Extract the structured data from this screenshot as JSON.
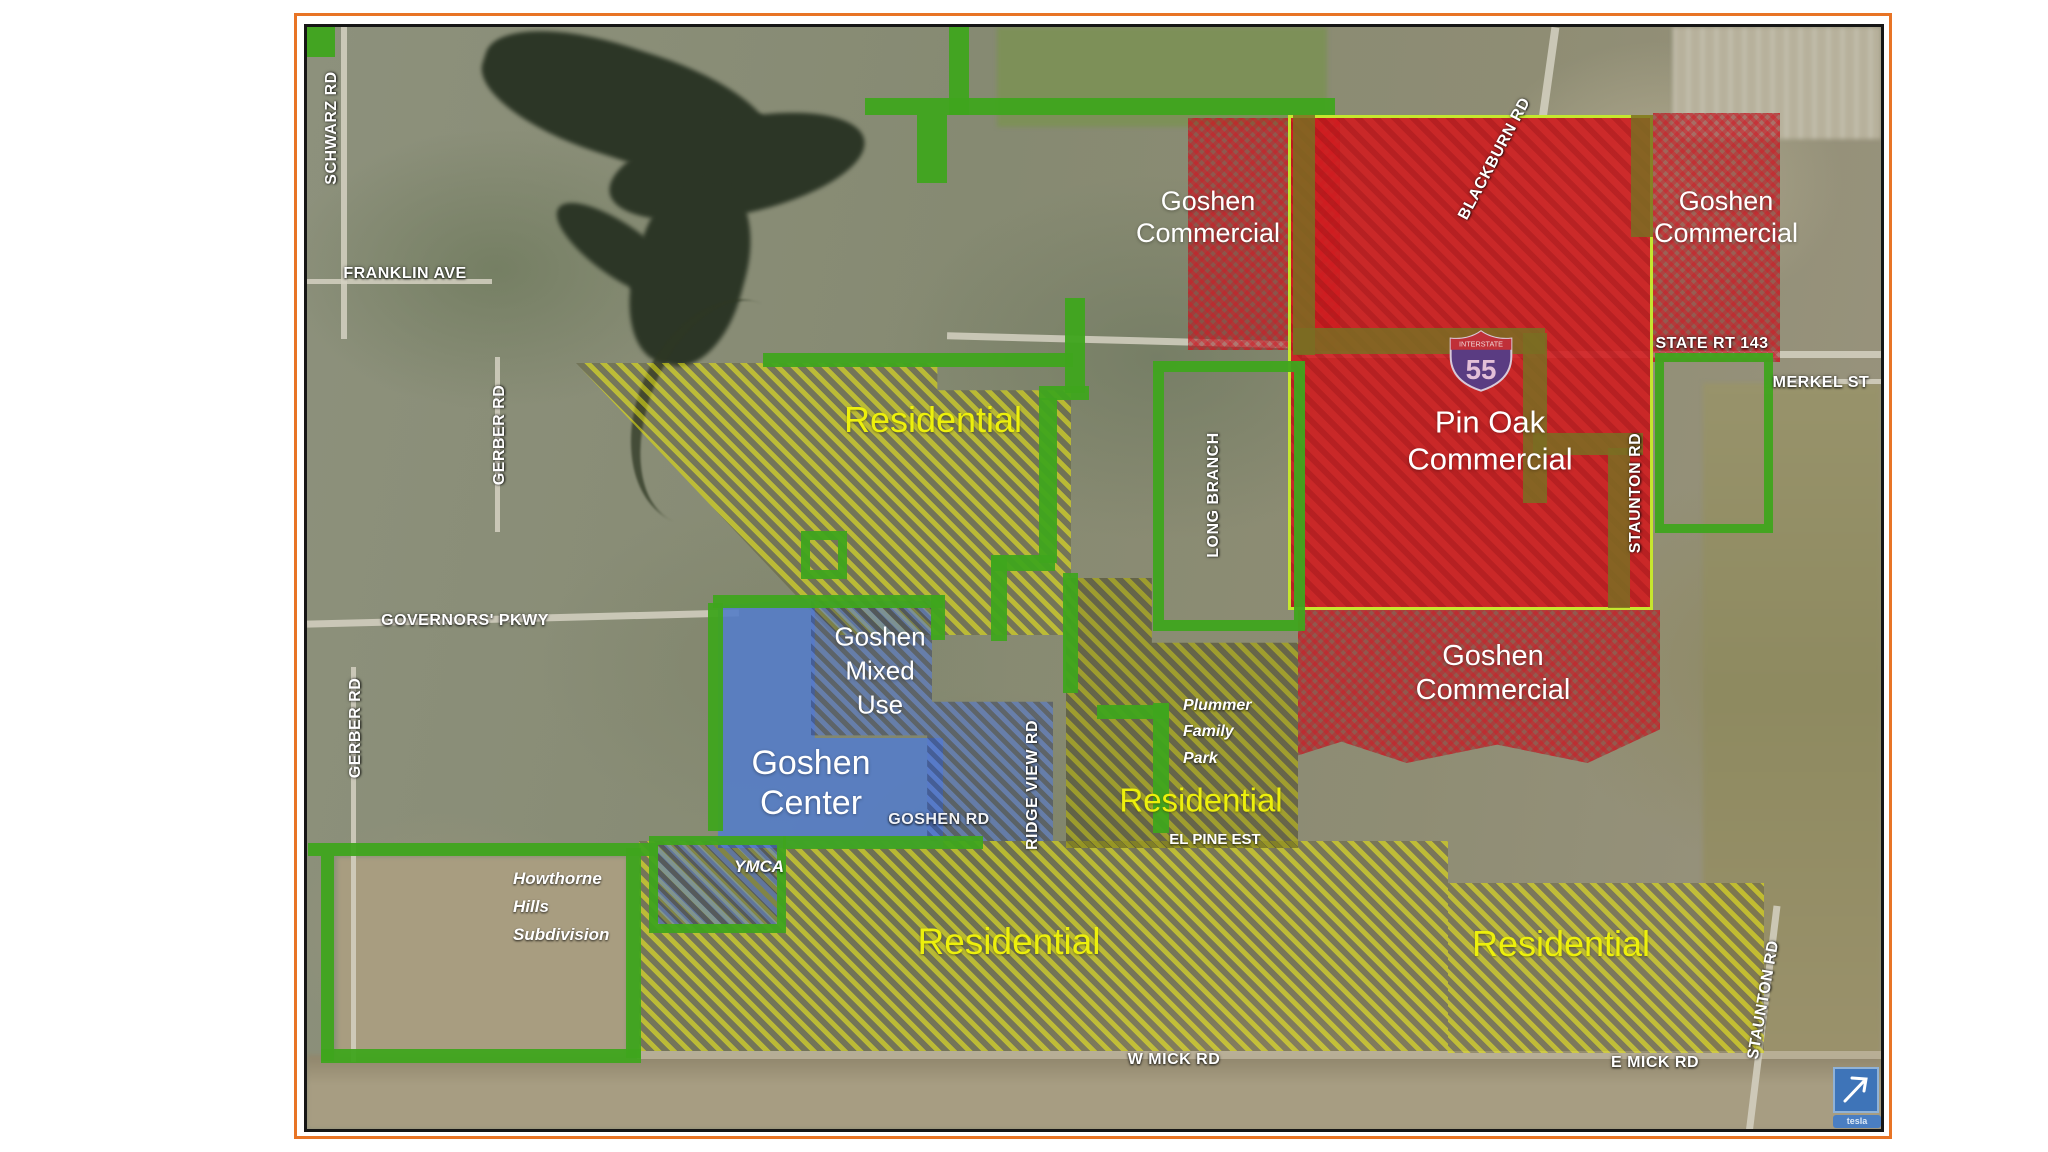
{
  "roads": [
    {
      "text": "SCHWARZ RD"
    },
    {
      "text": "FRANKLIN AVE"
    },
    {
      "text": "GERBER RD"
    },
    {
      "text": "GERBER RD"
    },
    {
      "text": "GOVERNORS' PKWY"
    },
    {
      "text": "BLACKBURN RD"
    },
    {
      "text": "STATE RT 143"
    },
    {
      "text": "MERKEL ST"
    },
    {
      "text": "STAUNTON RD"
    },
    {
      "text": "LONG BRANCH"
    },
    {
      "text": "RIDGE VIEW RD"
    },
    {
      "text": "GOSHEN RD"
    },
    {
      "text": "W MICK RD"
    },
    {
      "text": "E MICK RD"
    },
    {
      "text": "STAUNTON RD"
    }
  ],
  "zones": {
    "goshen_commercial_nw": {
      "lines": [
        "Goshen",
        "Commercial"
      ]
    },
    "goshen_commercial_ne": {
      "lines": [
        "Goshen",
        "Commercial"
      ]
    },
    "pin_oak_commercial": {
      "lines": [
        "Pin Oak",
        "Commercial"
      ]
    },
    "goshen_commercial_mid": {
      "lines": [
        "Goshen",
        "Commercial"
      ]
    },
    "residential_upper": {
      "text": "Residential"
    },
    "residential_center": {
      "text": "Residential"
    },
    "residential_bottom": {
      "text": "Residential"
    },
    "residential_bottom_right": {
      "text": "Residential"
    },
    "goshen_mixed_use": {
      "lines": [
        "Goshen",
        "Mixed",
        "Use"
      ]
    },
    "goshen_center": {
      "lines": [
        "Goshen",
        "Center"
      ]
    }
  },
  "landmarks": {
    "ymca": {
      "text": "YMCA"
    },
    "howthorne": {
      "lines": [
        "Howthorne",
        "Hills",
        "Subdivision"
      ]
    },
    "plummer": {
      "lines": [
        "Plummer",
        "Family",
        "Park"
      ]
    },
    "el_pine": {
      "text": "EL PINE EST"
    }
  },
  "shield": {
    "band": "INTERSTATE",
    "number": "55"
  },
  "attribution": {
    "text": "tesla"
  },
  "colors": {
    "frame": "#e87425",
    "boundary_green": "#3fa51e",
    "zone_yellow": "#e5e20e",
    "zone_red": "#cc2433",
    "pin_oak_fill": "#d32027",
    "pin_oak_border": "#c6e62e",
    "zone_blue": "#577ec9",
    "label_yellow": "#edf00c"
  }
}
